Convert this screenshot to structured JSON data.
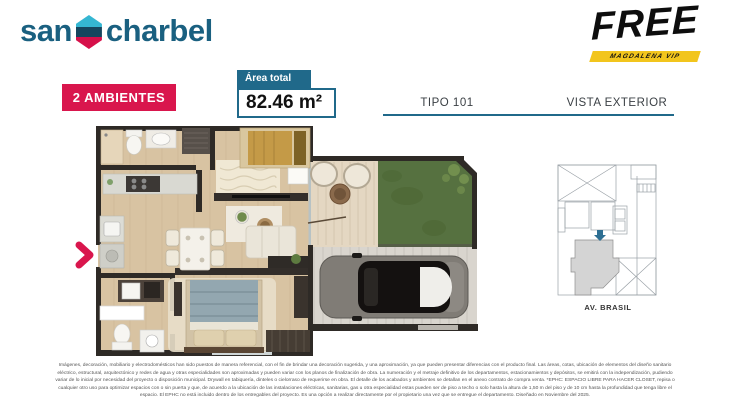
{
  "theme": {
    "brand_blue": "#1a6080",
    "teal": "#20698a",
    "crimson": "#d9164d",
    "yellow": "#f2c51d",
    "label_gray": "#3b4045",
    "hex_cyan": "#35b6d2",
    "hex_dark": "#16455e",
    "hex_red": "#d6104a",
    "wall": "#2e2a26",
    "wood": "#d8c3a2",
    "deck": "#e4d7c2",
    "grass": "#567140",
    "concrete": "#d9d5ce"
  },
  "header": {
    "brand_word1": "san",
    "brand_word2": "charbel",
    "free_title": "FREE",
    "free_subtitle": "MAGDALENA VIP"
  },
  "info": {
    "rooms_badge": "2 AMBIENTES",
    "area_label": "Área total",
    "area_value": "82.46 m²",
    "tipo": "TIPO 101",
    "vista": "VISTA EXTERIOR"
  },
  "siteplan": {
    "street_label": "AV. BRASIL"
  },
  "footer": {
    "disclaimer_lines": [
      "Imágenes, decoración, mobiliario y electrodomésticos han sido puestos de manera referencial, con el fin de brindar una decoración sugerida, y una aproximación, ya que pueden presentar diferencias con el producto final. Las áreas, cotas, ubicación de elementos del diseño sanitario",
      "eléctrico, estructural, arquitectónico y redes de agua y otras especialidades son aproximadas y pueden variar con los planos de finalización de obra. La numeración y el metraje definitivo de los departamentos, estacionamientos y depósitos, se emitirá con la independización, pudiendo",
      "variar de lo inicial por necesidad del proyecto o disposición municipal. Drywall en tabiquería, dinteles o cielorraso de requerirse en obra. El detalle de los acabados y ambientes se detallan en el anexo contrato de compra venta. *EPHC: ESPACIO LIBRE PARA HACER CLOSET, repisa o",
      "cualquier otro uso para optimizar espacios con o sin puerta y que, de acuerdo a la ubicación de las instalaciones eléctricas, sanitarias, gas u otra especialidad estas pueden ser de piso a techo o solo hasta la altura de 1,50 m del piso y de 10 cm hasta la profundidad que tenga libre el",
      "espacio. El EPHC no está incluido dentro de los entregables del proyecto. Es una opción a realizar directamente por el propietario una vez que se entregue el departamento. Diseñado en Noviembre del 2025."
    ]
  }
}
